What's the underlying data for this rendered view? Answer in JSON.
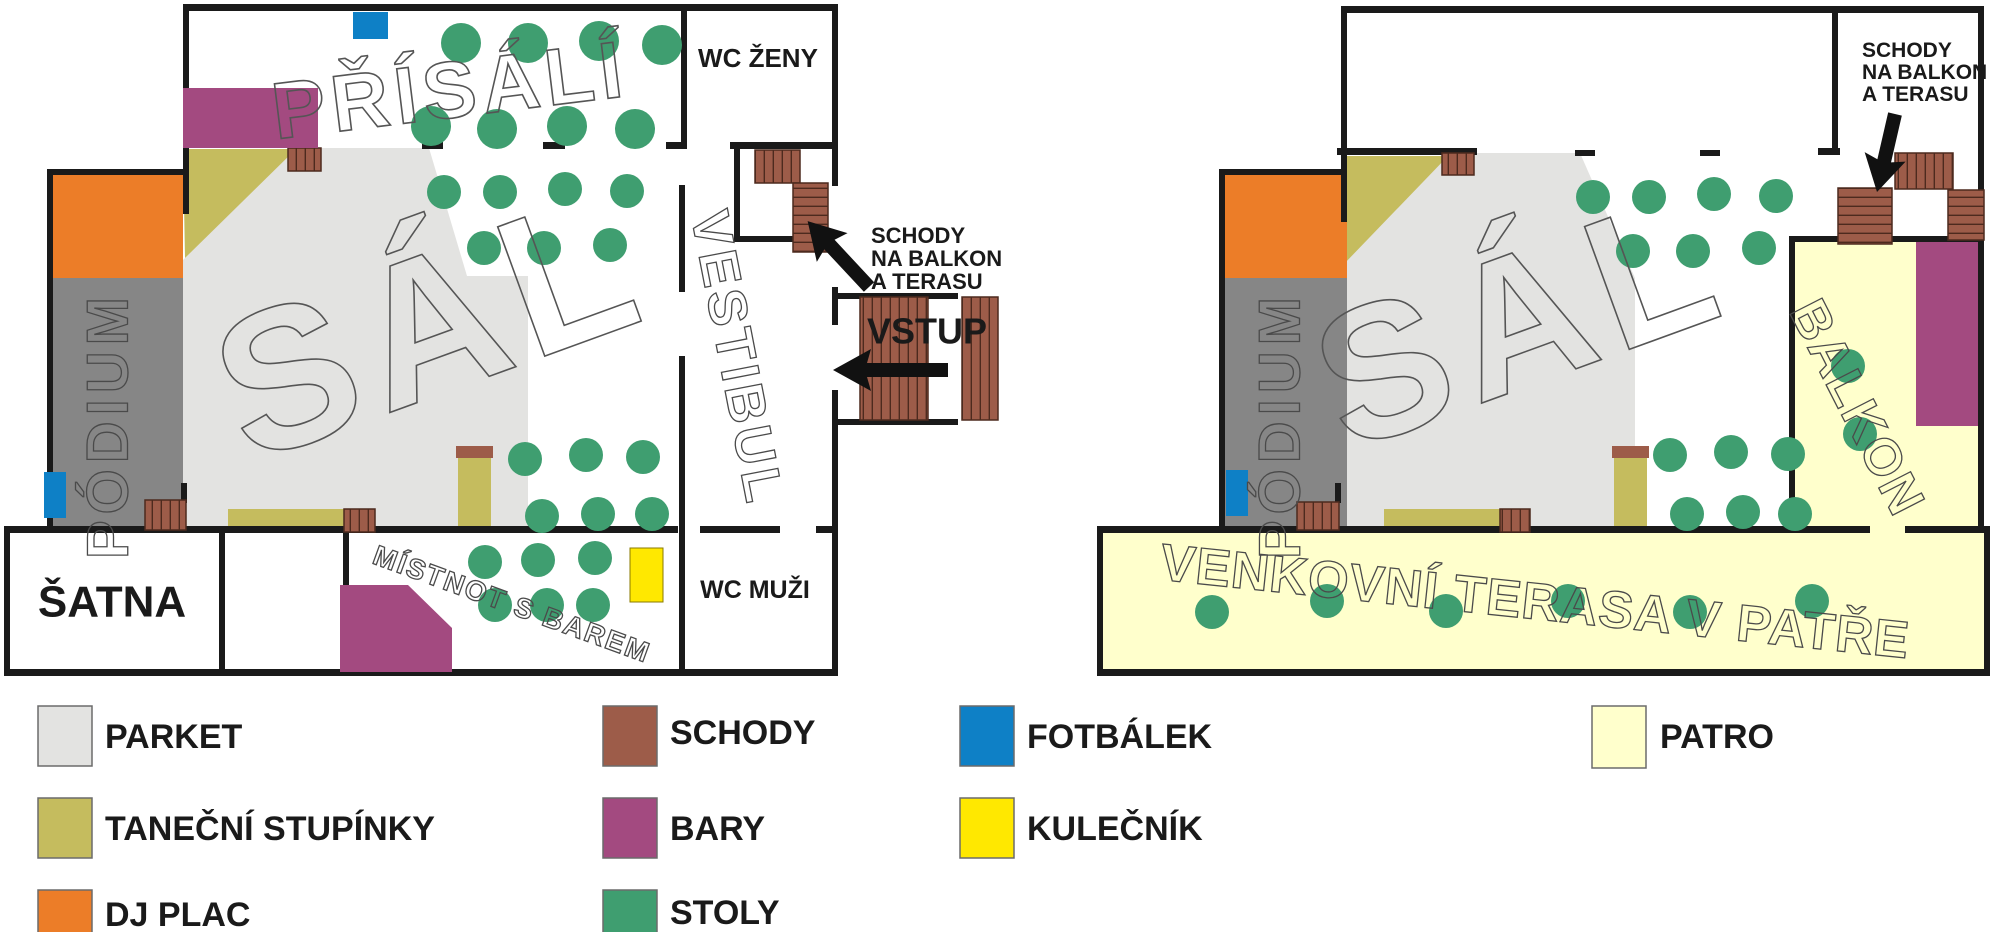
{
  "palette": {
    "wall": "#1a1a1a",
    "arrow": "#111111",
    "parket": "#e3e3e1",
    "podium": "#868686",
    "dj": "#ec7d28",
    "tanecni": "#c5bc5e",
    "schody": "#9d5c49",
    "schody_line": "#4d2a1e",
    "bary": "#a34a80",
    "stoly": "#3f9e70",
    "fotbalek": "#0e80c6",
    "kulecnik": "#ffe800",
    "patro": "#ffffcc"
  },
  "ground_floor": {
    "prisali": "PŘÍSÁLÍ",
    "sal": "SÁL",
    "podium": "PÓDIUM",
    "vestibul": "VESTIBUL",
    "wc_zeny": "WC ŽENY",
    "wc_muzi": "WC MUŽI",
    "satna": "ŠATNA",
    "bar_room": "MÍSTNOT S BAREM",
    "vstup": "VSTUP",
    "stairs_note": [
      "SCHODY",
      "NA BALKON",
      "A TERASU"
    ]
  },
  "upper_floor": {
    "sal": "SÁL",
    "podium": "PÓDIUM",
    "balkon": "BALKON",
    "terasa": "VENKOVNÍ TERASA V PATŘE",
    "stairs_note": [
      "SCHODY",
      "NA BALKON",
      "A TERASU"
    ]
  },
  "legend": {
    "items": [
      {
        "id": "parket",
        "label": "PARKET",
        "color": "#e3e3e1"
      },
      {
        "id": "tanecni",
        "label": "TANEČNÍ STUPÍNKY",
        "color": "#c5bc5e"
      },
      {
        "id": "dj",
        "label": "DJ PLAC",
        "color": "#ec7d28"
      },
      {
        "id": "schody",
        "label": "SCHODY",
        "color": "#9d5c49"
      },
      {
        "id": "bary",
        "label": "BARY",
        "color": "#a34a80"
      },
      {
        "id": "stoly",
        "label": "STOLY",
        "color": "#3f9e70"
      },
      {
        "id": "fotbalek",
        "label": "FOTBÁLEK",
        "color": "#0e80c6"
      },
      {
        "id": "kulecnik",
        "label": "KULEČNÍK",
        "color": "#ffe800"
      },
      {
        "id": "patro",
        "label": "PATRO",
        "color": "#ffffcc"
      }
    ]
  }
}
